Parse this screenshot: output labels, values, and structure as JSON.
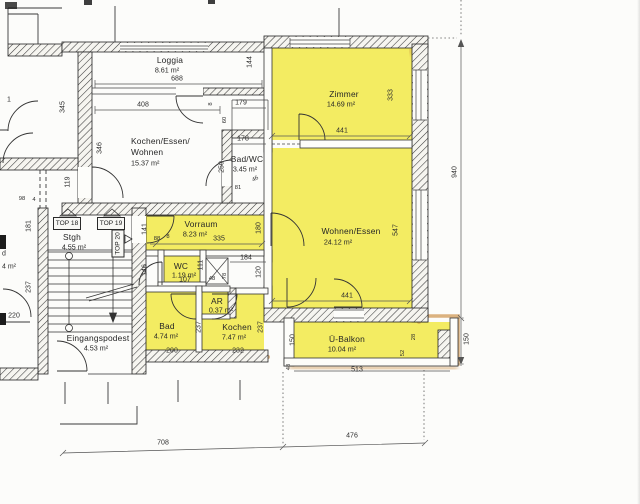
{
  "colors": {
    "highlight": "#f3ec62",
    "marker": "#c98a3d",
    "wall": "#2b2b2b",
    "paper": "#fcfcfa"
  },
  "rooms": {
    "loggia": {
      "name": "Loggia",
      "area": "8.61 m²"
    },
    "kochen_essen_wohnen": {
      "line1": "Kochen/Essen/",
      "line2": "Wohnen",
      "area": "15.37 m²"
    },
    "bad_wc": {
      "name": "Bad/WC",
      "area": "3.45 m²"
    },
    "zimmer": {
      "name": "Zimmer",
      "area": "14.69 m²"
    },
    "wohnen_essen": {
      "name": "Wohnen/Essen",
      "area": "24.12 m²"
    },
    "vorraum": {
      "name": "Vorraum",
      "area": "8.23 m²"
    },
    "wc": {
      "name": "WC",
      "area": "1.19 m²"
    },
    "ar": {
      "name": "AR",
      "area": "0.37 m²"
    },
    "bad": {
      "name": "Bad",
      "area": "4.74 m²"
    },
    "kochen": {
      "name": "Kochen",
      "area": "7.47 m²"
    },
    "ue_balkon": {
      "name": "Ü-Balkon",
      "area": "10.04 m²"
    },
    "stgh": {
      "name": "Stgh",
      "area": "4.55 m²"
    },
    "eingangspodest": {
      "name": "Eingangspodest",
      "area": "4.53 m²"
    }
  },
  "units": {
    "top18": "TOP 18",
    "top19": "TOP 19",
    "top20": "TOP 20"
  },
  "partial": {
    "one": "1",
    "d": "d",
    "four_sqm": "4 m²"
  },
  "dims": {
    "loggia_width": "688",
    "loggia_depth": "144",
    "kew_width": "408",
    "shaft_width": "179",
    "shaft_h1": "8",
    "shaft_h2": "60",
    "badwc_width": "178",
    "badwc_height": "250",
    "badwc_offset": "46",
    "badwc_small": "81",
    "left_height1": "345",
    "kew_height": "346",
    "corridor": "119",
    "left_small1": "98",
    "left_small2": "4",
    "stair_left1": "181",
    "stair_left2": "237",
    "stair_bottom": "220",
    "vorraum_left": "141",
    "wc_left": "146",
    "vorraum_width": "335",
    "vorraum_small1": "88",
    "vorraum_small2": "8",
    "vorraum_right": "180",
    "wc_height": "111",
    "wc_width": "107",
    "ar_width": "48",
    "kochen_top": "184",
    "ar_height": "78",
    "kochen_right_top": "120",
    "bad_height": "237",
    "kochen_height": "237",
    "bad_width": "200",
    "kochen_width": "232",
    "zimmer_width": "441",
    "zimmer_height": "333",
    "wohnen_width": "441",
    "wohnen_height": "547",
    "building_height": "940",
    "balkon_height_left": "150",
    "balkon_height_right": "150",
    "balkon_width": "513",
    "balkon_small_left": "48",
    "pillar_w": "28",
    "pillar_h": "52",
    "bottom_left": "708",
    "bottom_right": "476"
  }
}
